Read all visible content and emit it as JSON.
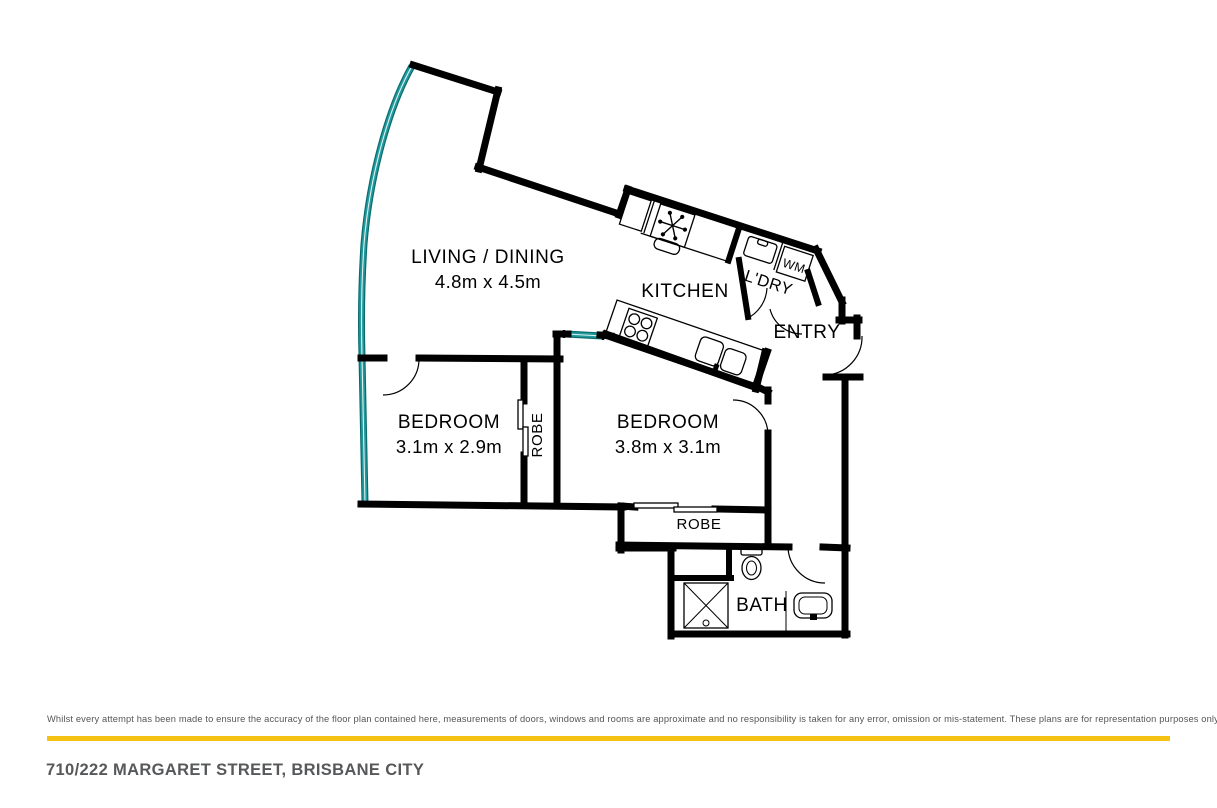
{
  "plan": {
    "living_label": "LIVING / DINING",
    "living_dims": "4.8m x 4.5m",
    "kitchen_label": "KITCHEN",
    "laundry_label": "L'DRY",
    "washing_machine_label": "WM",
    "entry_label": "ENTRY",
    "bedroom1_label": "BEDROOM",
    "bedroom1_dims": "3.1m x 2.9m",
    "robe1_label": "ROBE",
    "bedroom2_label": "BEDROOM",
    "bedroom2_dims": "3.8m x 3.1m",
    "robe2_label": "ROBE",
    "bath_label": "BATH"
  },
  "colors": {
    "wall": "#000000",
    "window_teal": "#229a9d",
    "accent_gold": "#f3c212",
    "address_text": "#57585a",
    "disclaimer_text": "#565656"
  },
  "footer": {
    "disclaimer": "Whilst every attempt has been made to ensure the accuracy of the floor plan contained here, measurements of doors, windows and rooms are approximate and no responsibility is taken for any error, omission or mis-statement. These plans are for representation purposes only.",
    "address": "710/222 MARGARET STREET, BRISBANE CITY"
  }
}
